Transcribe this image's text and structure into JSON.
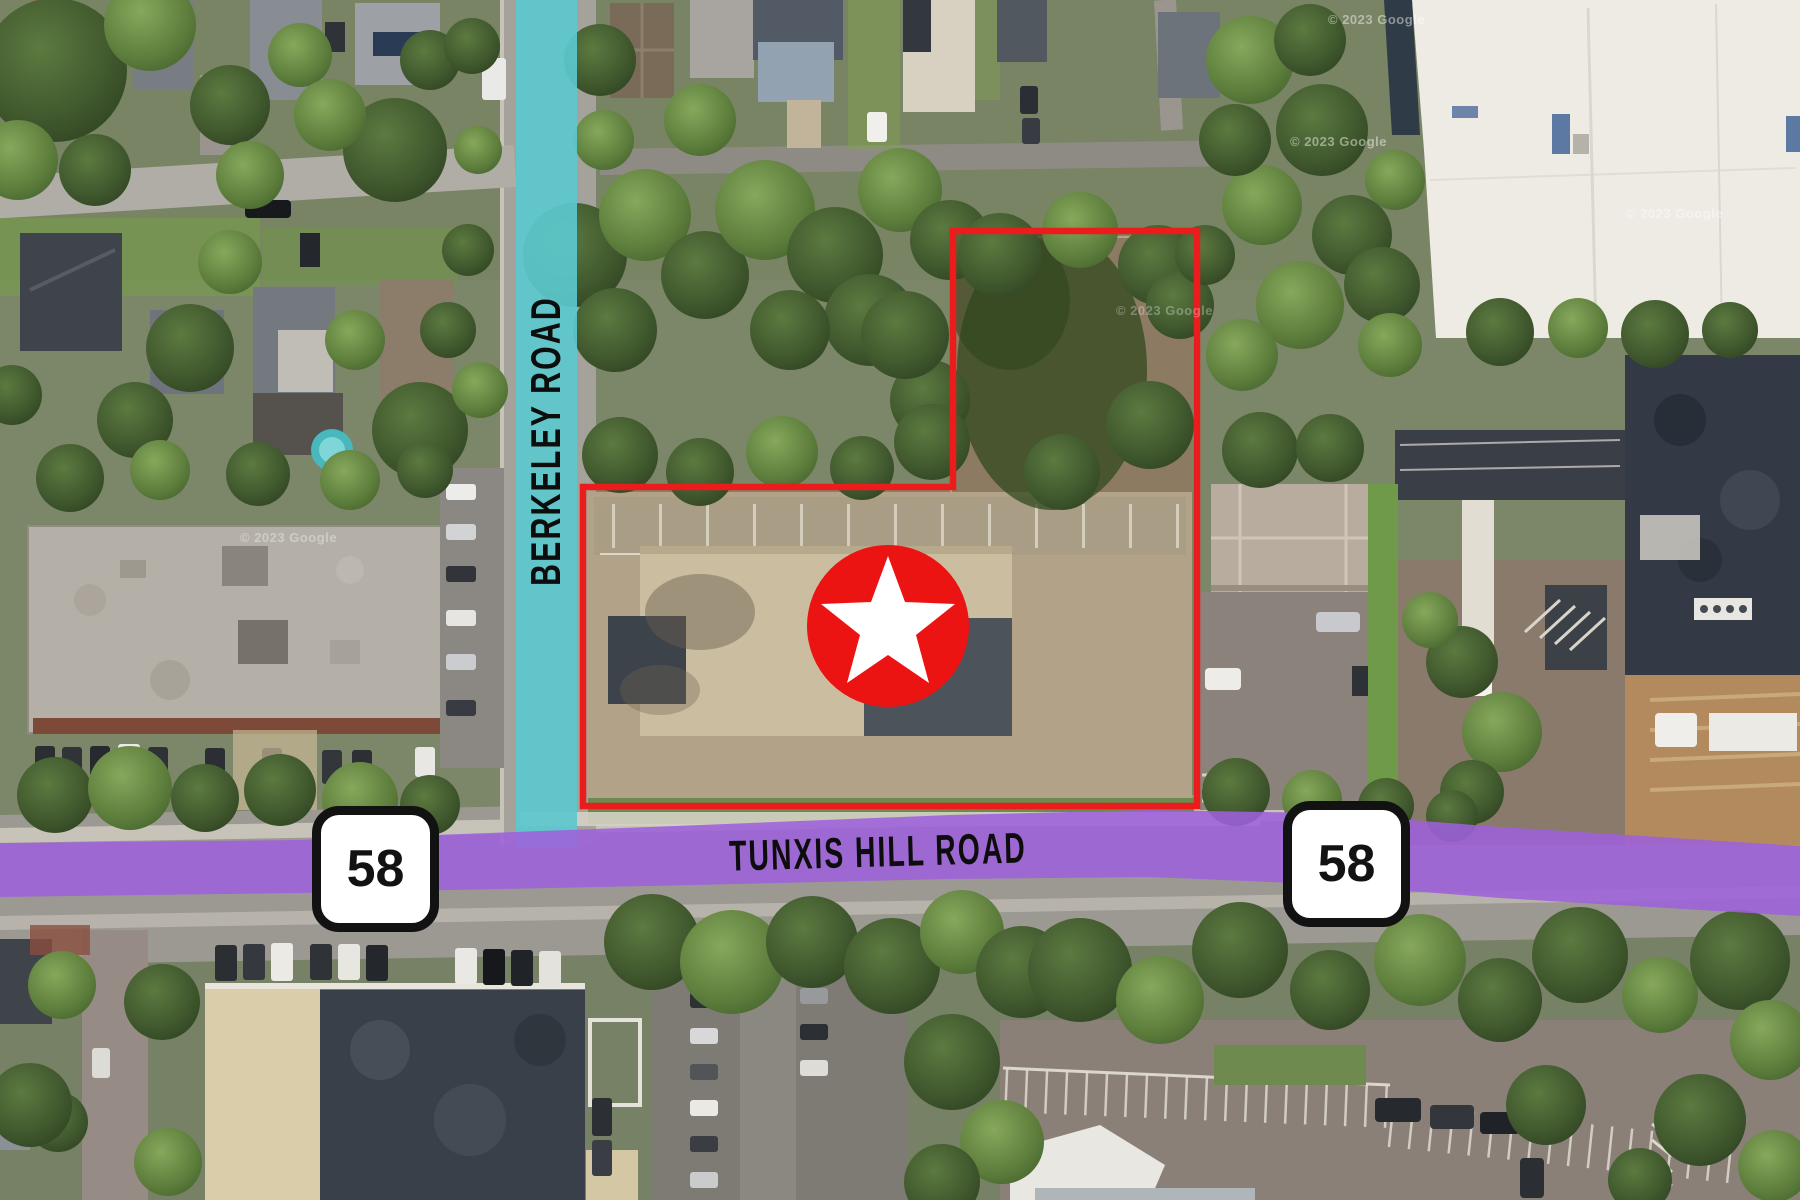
{
  "labels": {
    "vertical_road": "BERKELEY ROAD",
    "horizontal_road": "TUNXIS HILL ROAD",
    "route_left": "58",
    "route_right": "58"
  },
  "watermarks": {
    "items": [
      "© 2023 Google",
      "© 2023 Google",
      "© 2023 Google",
      "© 2023 Google",
      "© 2023 Google"
    ]
  },
  "marker": {
    "icon": "star-in-circle-icon"
  },
  "colors": {
    "teal-road": "#5CC8CD",
    "purple-road": "#9D61DB",
    "boundary-red": "#EA1C1C",
    "marker-red": "#EC1313",
    "star-white": "#FFFFFF",
    "shield-bg": "#FFFFFF",
    "shield-ink": "#121212",
    "label-ink": "#0D0D0D"
  }
}
